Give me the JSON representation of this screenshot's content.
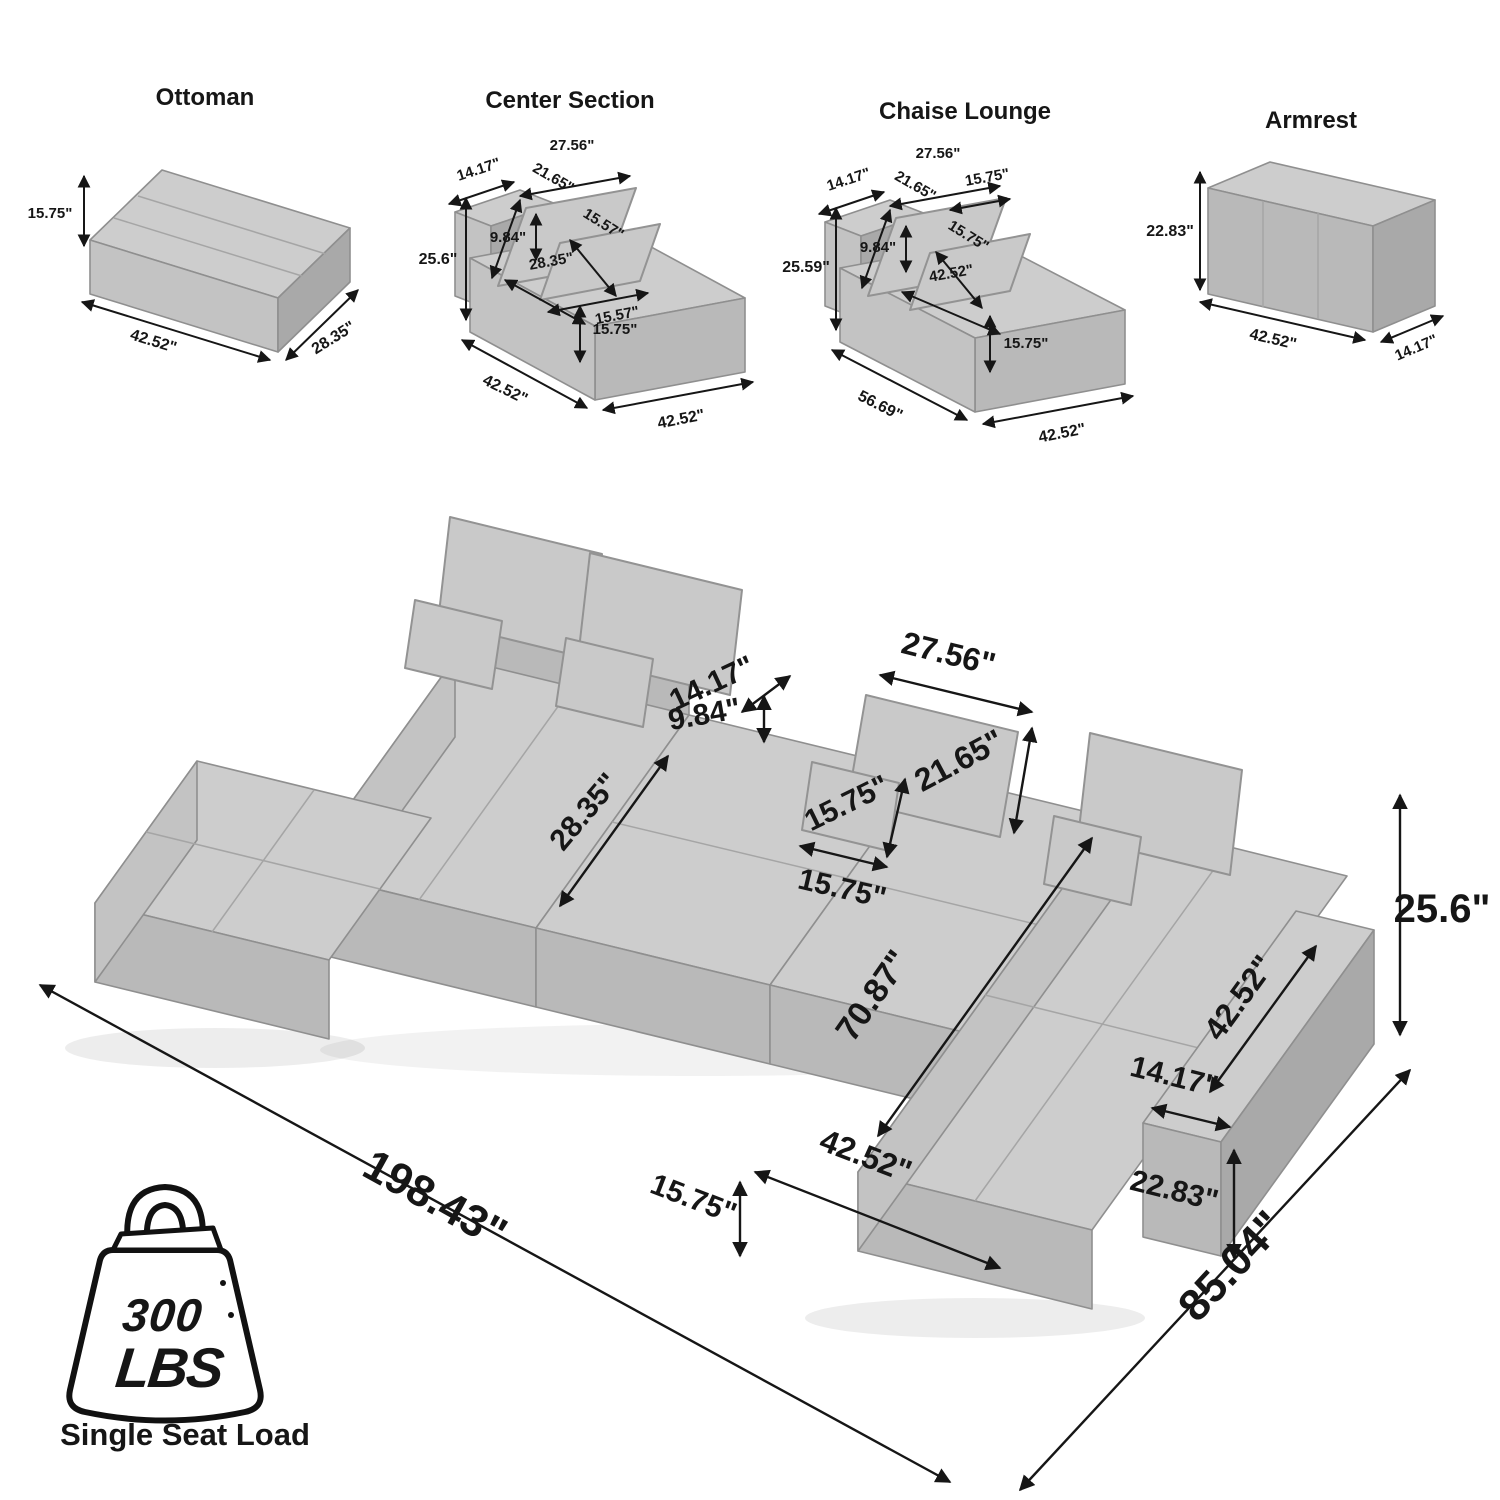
{
  "modules": {
    "ottoman": {
      "title": "Ottoman",
      "height": "15.75\"",
      "length": "42.52\"",
      "depth": "28.35\""
    },
    "center": {
      "title": "Center Section",
      "pillow_width": "27.56\"",
      "pillow_height": "21.65\"",
      "small_pillow_height": "15.57\"",
      "small_pillow_width": "15.57\"",
      "back_depth": "14.17\"",
      "back_rise": "9.84\"",
      "total_height": "25.6\"",
      "seat_depth": "28.35\"",
      "seat_front_height": "15.75\"",
      "length_left": "42.52\"",
      "length_right": "42.52\""
    },
    "chaise": {
      "title": "Chaise Lounge",
      "pillow_width": "27.56\"",
      "pillow_height": "21.65\"",
      "pillow_top_edge": "15.75\"",
      "small_pillow": "15.75\"",
      "back_depth": "14.17\"",
      "back_rise": "9.84\"",
      "total_height": "25.59\"",
      "seat_length": "42.52\"",
      "seat_front_height": "15.75\"",
      "depth_total": "56.69\"",
      "width_bottom": "42.52\""
    },
    "armrest": {
      "title": "Armrest",
      "height": "22.83\"",
      "length": "42.52\"",
      "depth": "14.17\""
    }
  },
  "main": {
    "back_depth": "14.17\"",
    "back_rise": "9.84\"",
    "seat_depth": "28.35\"",
    "pillow_width": "27.56\"",
    "pillow_height": "21.65\"",
    "small_pillow_height": "15.75\"",
    "small_pillow_width": "15.75\"",
    "total_height": "25.6\"",
    "armrest_length": "42.52\"",
    "armrest_width": "14.17\"",
    "armrest_height": "22.83\"",
    "chaise_length": "70.87\"",
    "chaise_width": "42.52\"",
    "front_height": "15.75\"",
    "overall_length": "198.43\"",
    "overall_depth": "85.04\""
  },
  "load": {
    "value": "300",
    "unit": "LBS",
    "caption": "Single Seat Load"
  }
}
